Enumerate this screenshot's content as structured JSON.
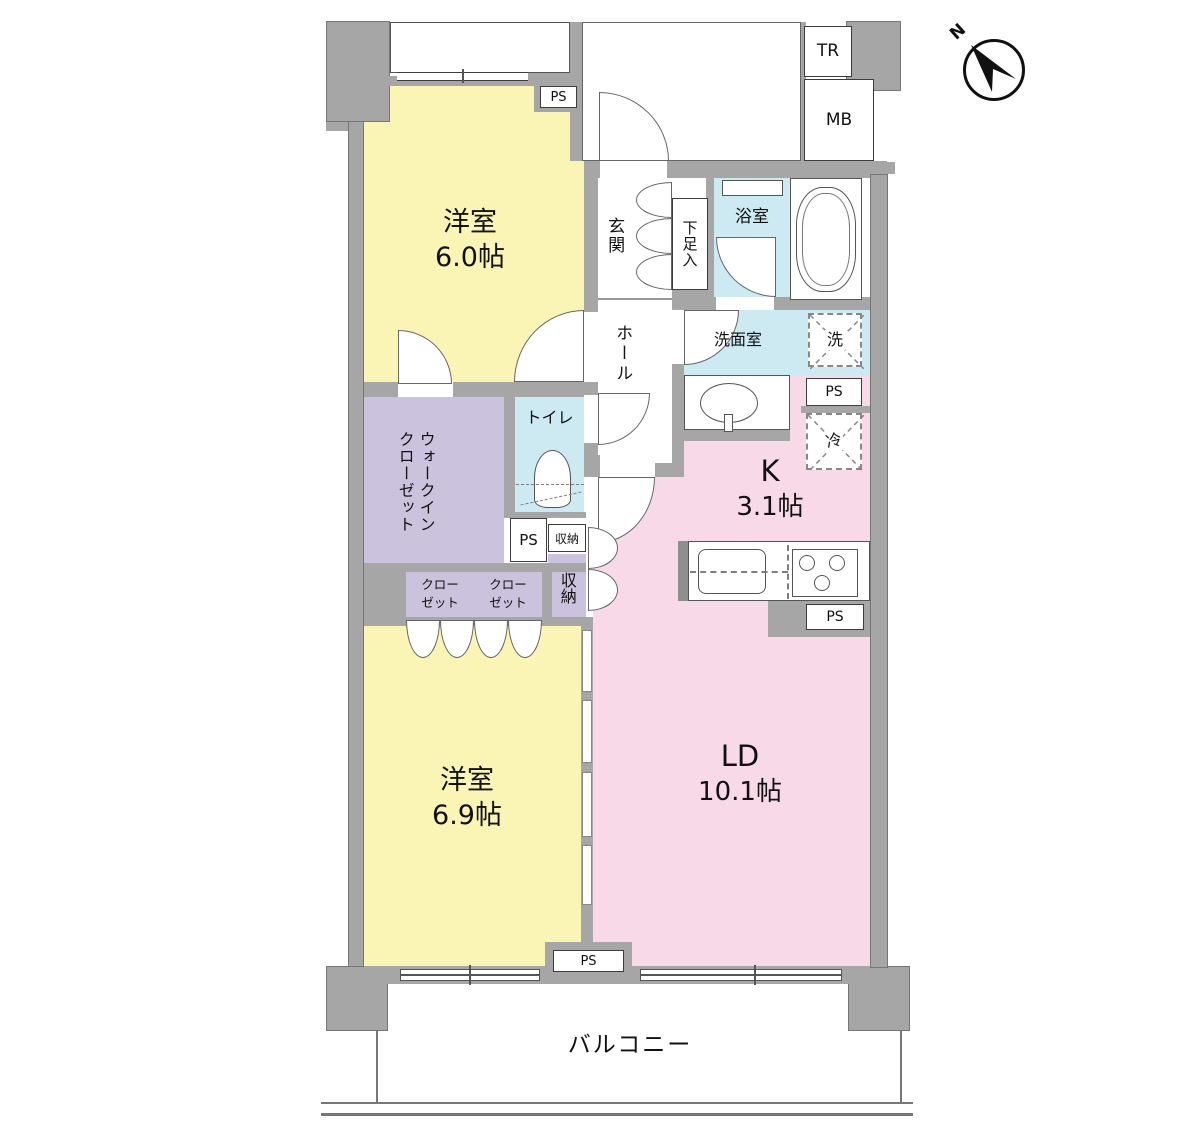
{
  "colors": {
    "room_yellow": "#FAF5B4",
    "room_pink": "#F8D9E7",
    "room_blue": "#CDE9F2",
    "room_purple": "#CBC2DD",
    "wall_gray": "#A6A6A6"
  },
  "compass": {
    "north": "N"
  },
  "rooms": {
    "bedroom1": {
      "name": "洋室",
      "area": "6.0帖"
    },
    "bedroom2": {
      "name": "洋室",
      "area": "6.9帖"
    },
    "kitchen": {
      "name": "K",
      "area": "3.1帖"
    },
    "living_dining": {
      "name": "LD",
      "area": "10.1帖"
    },
    "entrance": {
      "name": "玄関"
    },
    "hall": {
      "name": "ホール"
    },
    "shoe_cabinet": {
      "name": "下足入"
    },
    "bathroom": {
      "name": "浴室"
    },
    "washroom": {
      "name": "洗面室"
    },
    "toilet": {
      "name": "トイレ"
    },
    "walk_in_closet": {
      "line1": "ウォークイン",
      "line2": "クローゼット"
    },
    "closet": {
      "line1": "クロー",
      "line2": "ゼット"
    },
    "storage_small": {
      "name": "収納"
    },
    "storage_tall": {
      "name": "収納"
    },
    "balcony": {
      "name": "バルコニー"
    }
  },
  "equipment": {
    "ps": "PS",
    "tr": "TR",
    "mb": "MB",
    "washer": "洗",
    "fridge": "冷"
  }
}
